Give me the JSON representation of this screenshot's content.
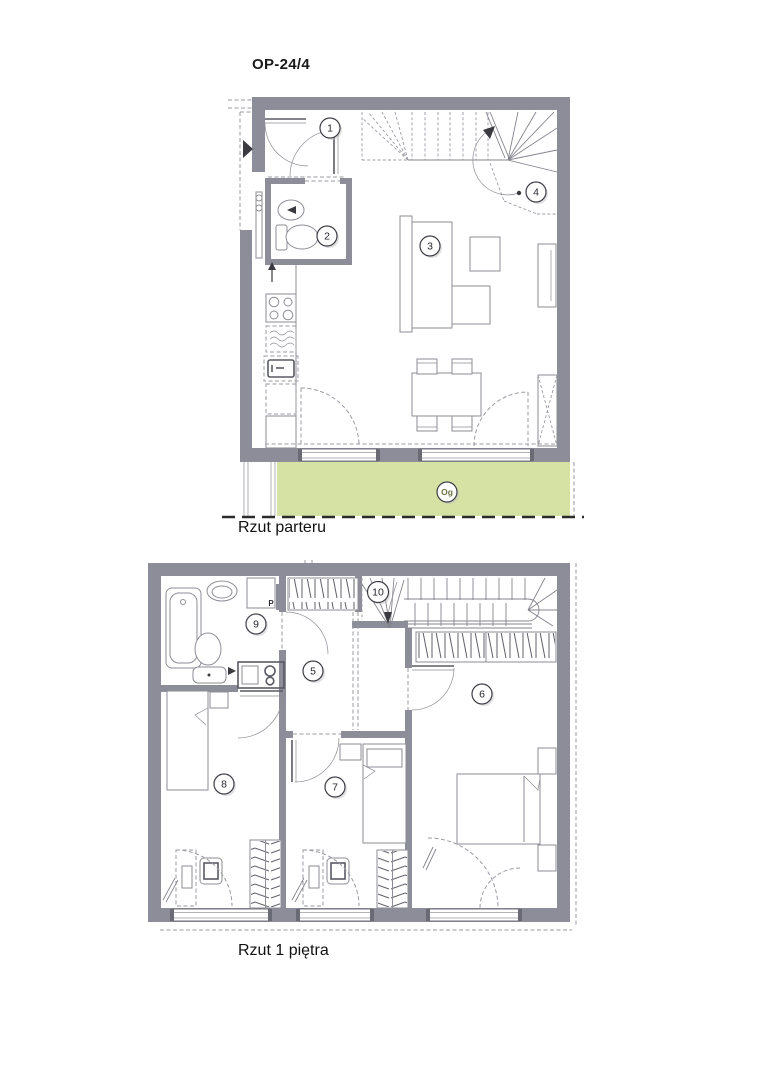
{
  "title": "OP-24/4",
  "colors": {
    "wall": "#8d8d99",
    "terrace": "#d6e2a4",
    "line": "#8e8e96",
    "dash": "#9a9aa3",
    "green_text": "#6b7440"
  },
  "floors": {
    "ground": {
      "caption": "Rzut parteru",
      "markers": {
        "m1": "1",
        "m2": "2",
        "m3": "3",
        "m4": "4",
        "og": "Og"
      }
    },
    "first": {
      "caption": "Rzut 1 piętra",
      "markers": {
        "m5": "5",
        "m6": "6",
        "m7": "7",
        "m8": "8",
        "m9": "9",
        "m10": "10",
        "p": "P"
      }
    }
  }
}
